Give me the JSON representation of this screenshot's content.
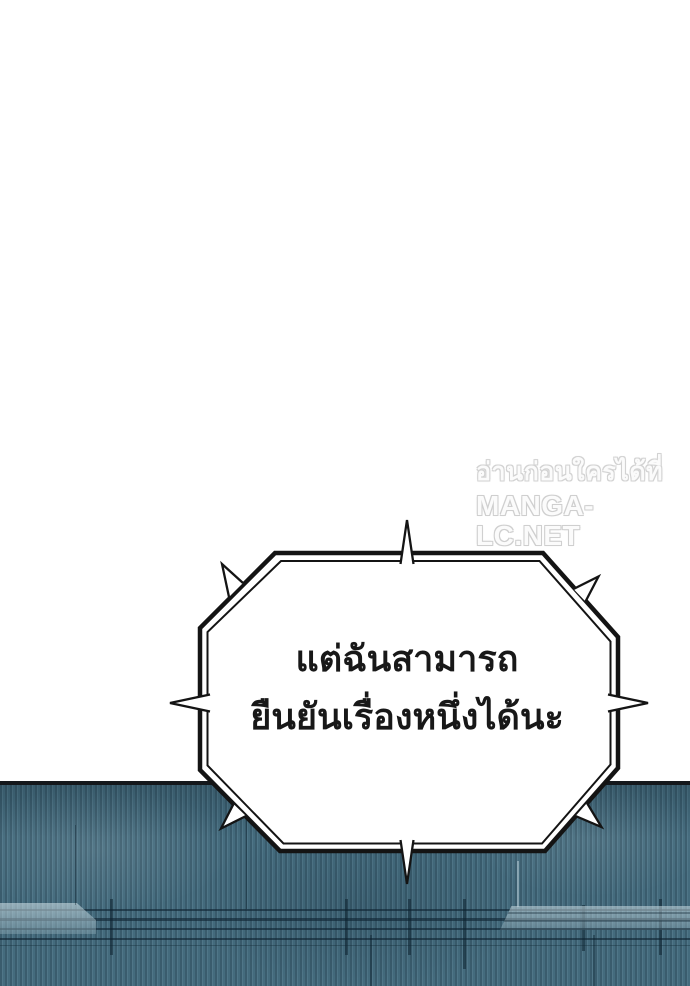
{
  "watermark": {
    "line1": "อ่านก่อนใครได้ที่",
    "line2": "MANGA-LC.NET",
    "fill_color": "#fbfbfb",
    "outline_color": "#d2d2d2"
  },
  "speech_bubble": {
    "line1": "แต่ฉันสามารถ",
    "line2": "ยืนยันเรื่องหนึ่งได้นะ",
    "fill": "#ffffff",
    "border_color": "#141414",
    "text_color": "#181818"
  },
  "wall": {
    "base_color": "#446b7d",
    "stripe_dark": "#3a5c6d",
    "stripe_light": "#547b8d",
    "pipe_line_color": "#0e2432",
    "duct_highlight": "#cddee4",
    "top_border_color": "#14181c"
  }
}
